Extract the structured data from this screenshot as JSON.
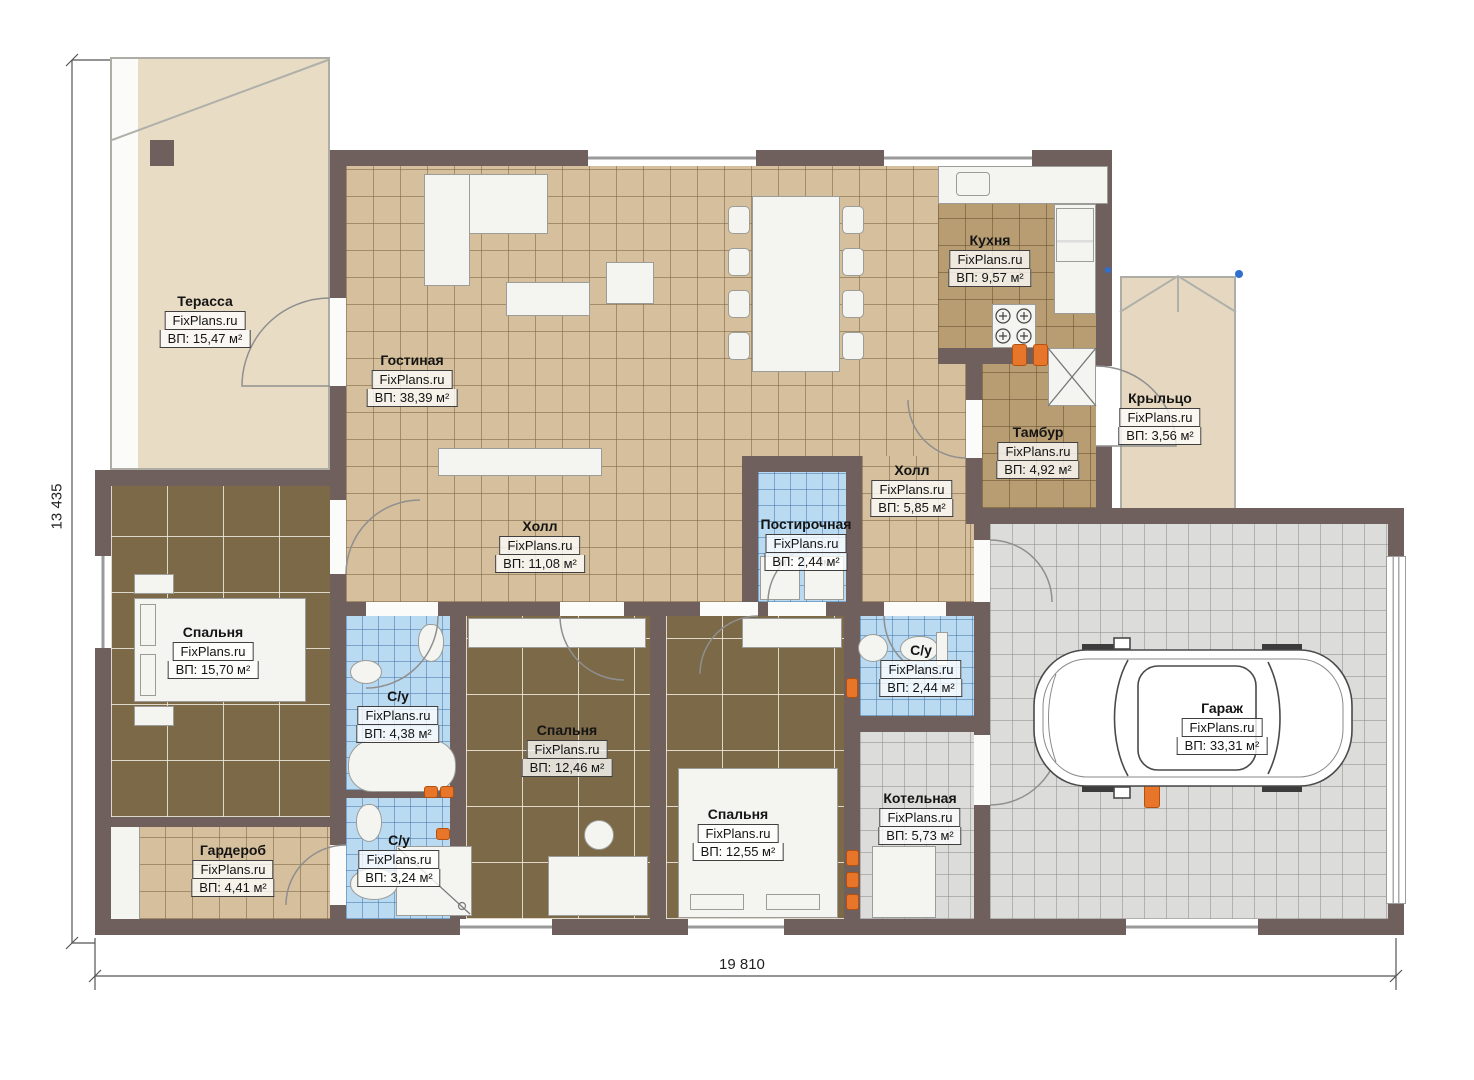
{
  "brand": "FixPlans.ru",
  "dimensions": {
    "width_label": "19 810",
    "height_label": "13 435"
  },
  "rooms": [
    {
      "name": "Терасса",
      "area": "ВП: 15,47 м²"
    },
    {
      "name": "Гостиная",
      "area": "ВП: 38,39 м²"
    },
    {
      "name": "Кухня",
      "area": "ВП: 9,57 м²"
    },
    {
      "name": "Крыльцо",
      "area": "ВП: 3,56 м²"
    },
    {
      "name": "Тамбур",
      "area": "ВП: 4,92 м²"
    },
    {
      "name": "Холл",
      "area": "ВП: 5,85 м²"
    },
    {
      "name": "Постирочная",
      "area": "ВП: 2,44 м²"
    },
    {
      "name": "Холл",
      "area": "ВП: 11,08 м²"
    },
    {
      "name": "Спальня",
      "area": "ВП: 15,70 м²"
    },
    {
      "name": "С/у",
      "area": "ВП: 4,38 м²"
    },
    {
      "name": "Спальня",
      "area": "ВП: 12,46 м²"
    },
    {
      "name": "Спальня",
      "area": "ВП: 12,55 м²"
    },
    {
      "name": "С/у",
      "area": "ВП: 2,44 м²"
    },
    {
      "name": "Котельная",
      "area": "ВП: 5,73 м²"
    },
    {
      "name": "Гараж",
      "area": "ВП: 33,31 м²"
    },
    {
      "name": "Гардероб",
      "area": "ВП: 4,41 м²"
    },
    {
      "name": "С/у",
      "area": "ВП: 3,24 м²"
    }
  ],
  "appliances": {
    "washer1": "СМ",
    "washer2": "СМ"
  },
  "colors": {
    "wall": "#6f5f5d",
    "floor_beige": "#d5bf9c",
    "floor_brown": "#b89d72",
    "floor_dark": "#7b6947",
    "floor_blue": "#b9daf0",
    "floor_gray": "#dcdcdb",
    "accent_orange": "#e8762a"
  }
}
